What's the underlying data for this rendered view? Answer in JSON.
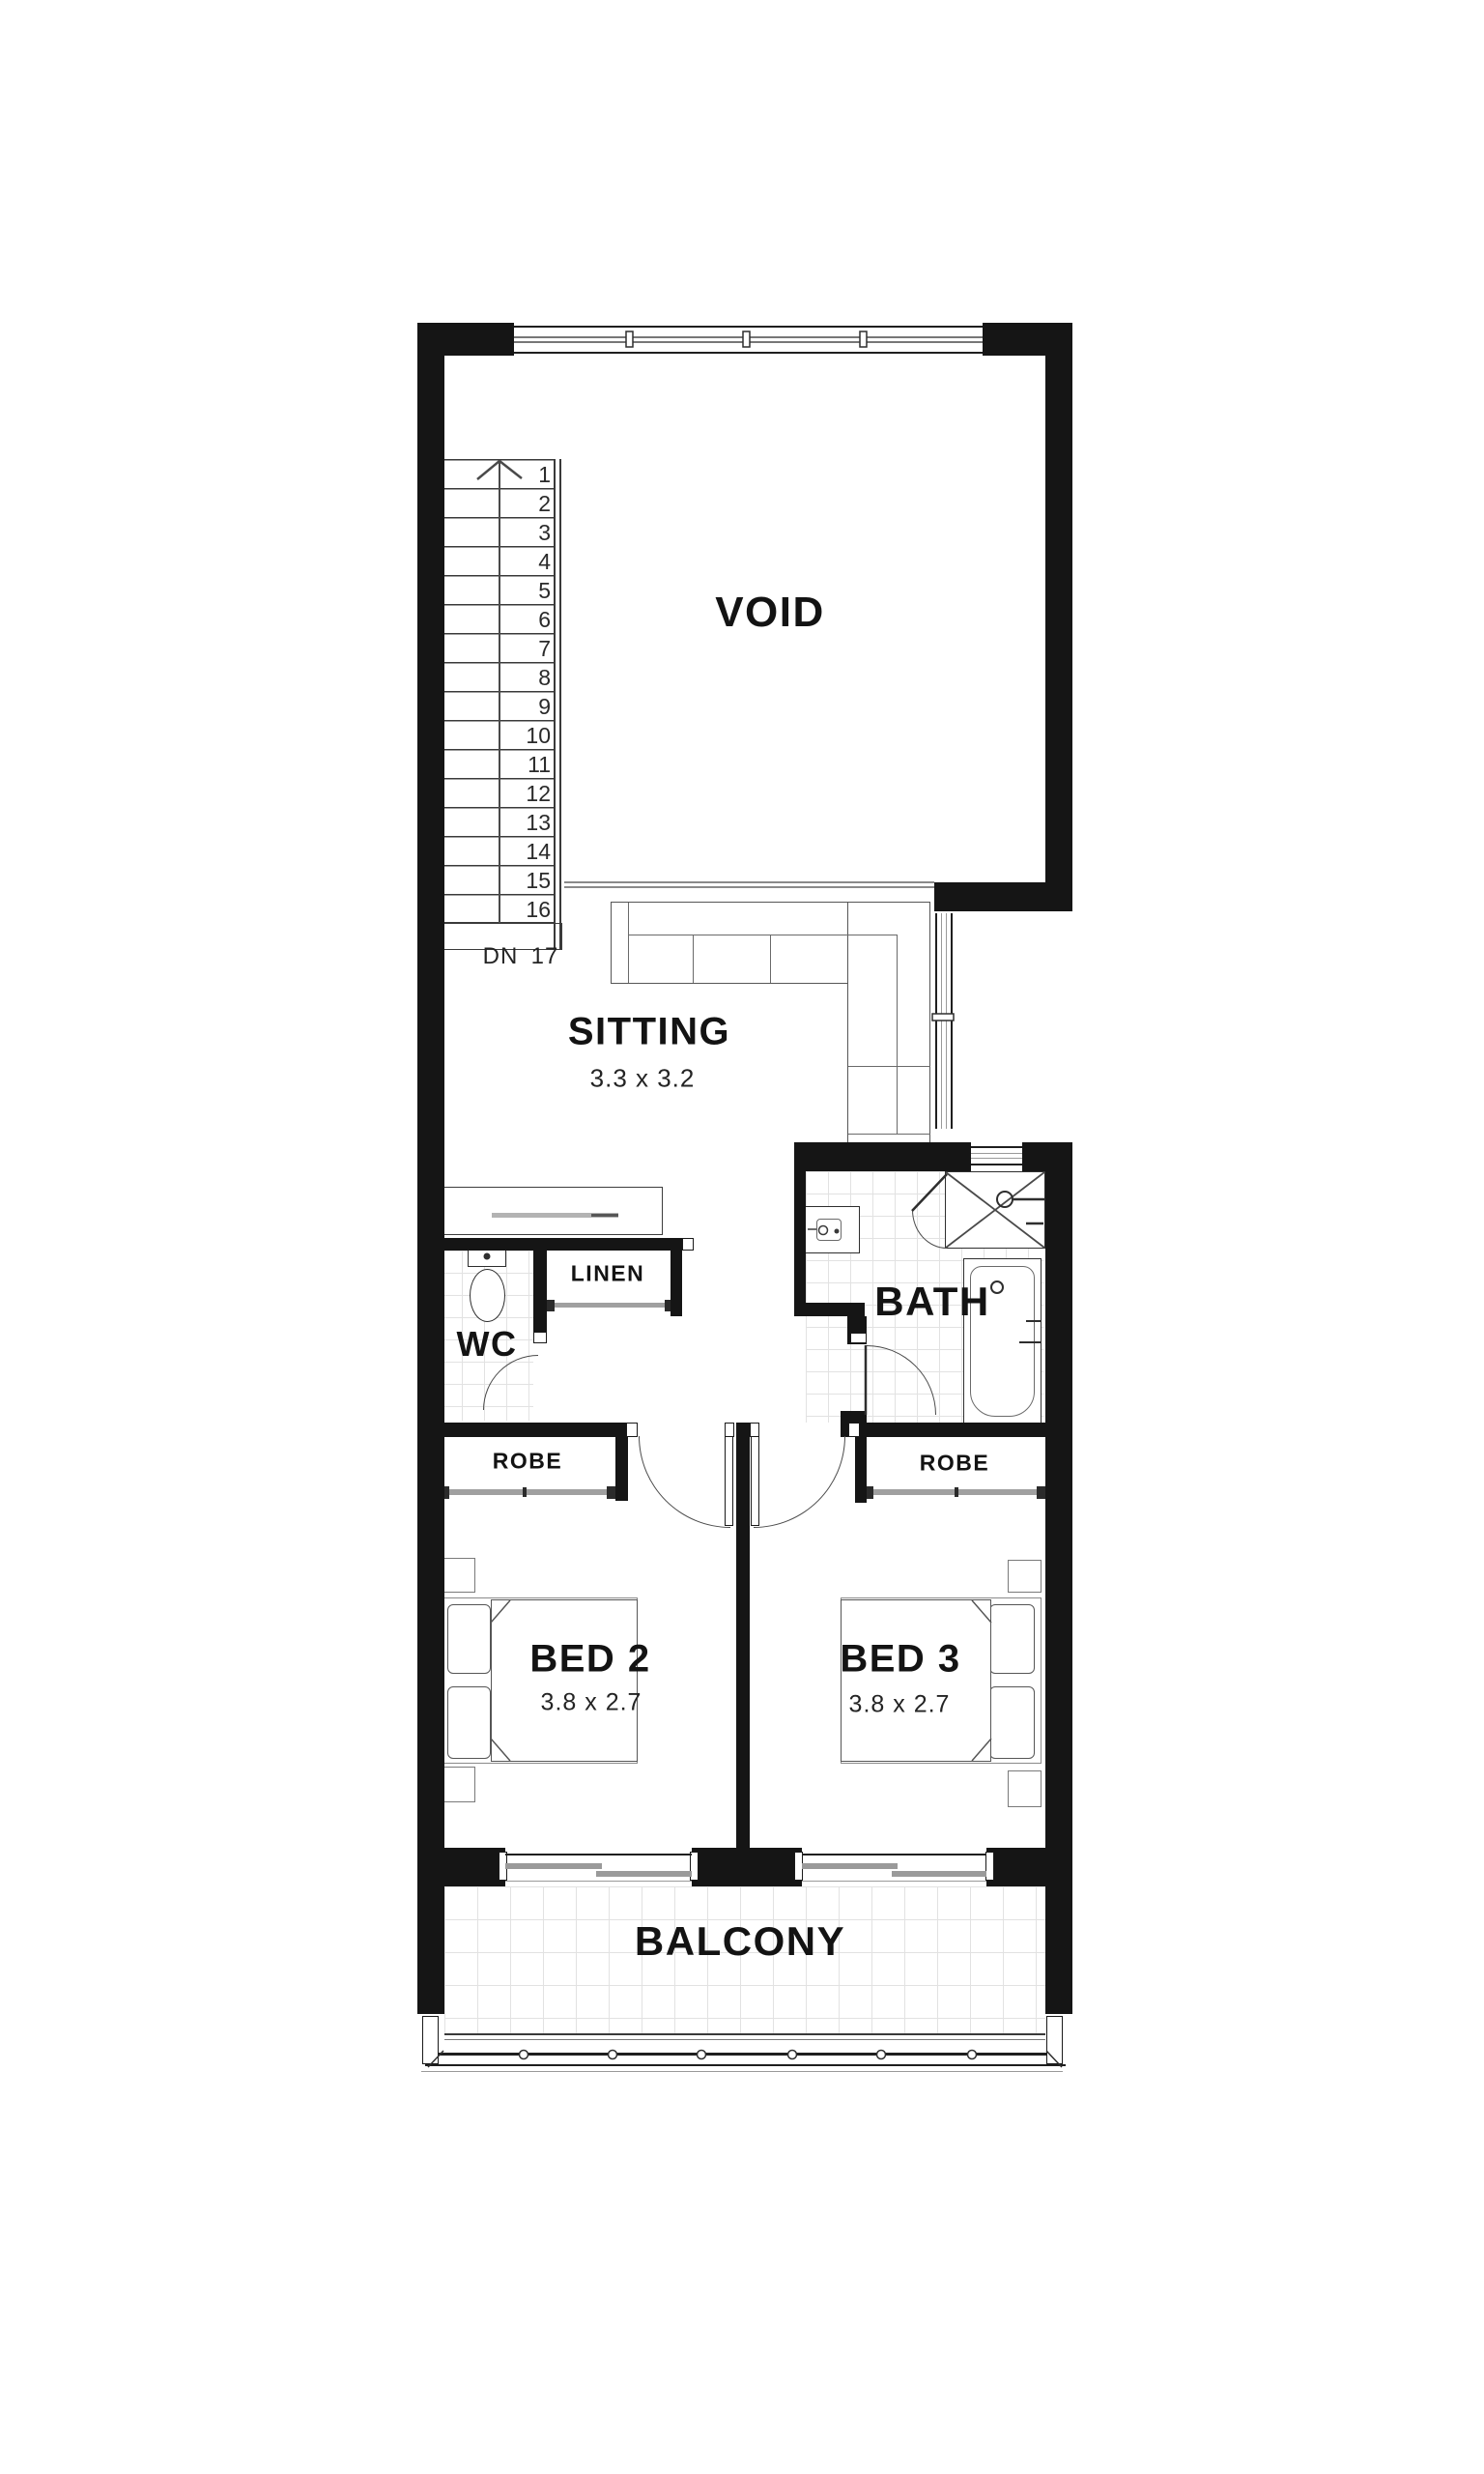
{
  "rooms": {
    "void": {
      "label": "VOID"
    },
    "sitting": {
      "label": "SITTING",
      "dims": "3.3 x 3.2"
    },
    "wc": {
      "label": "WC"
    },
    "linen": {
      "label": "LINEN"
    },
    "bath": {
      "label": "BATH"
    },
    "robe_left": {
      "label": "ROBE"
    },
    "robe_right": {
      "label": "ROBE"
    },
    "bed2": {
      "label": "BED 2",
      "dims": "3.8 x 2.7"
    },
    "bed3": {
      "label": "BED 3",
      "dims": "3.8 x 2.7"
    },
    "balcony": {
      "label": "BALCONY"
    }
  },
  "stairs": {
    "steps": [
      "1",
      "2",
      "3",
      "4",
      "5",
      "6",
      "7",
      "8",
      "9",
      "10",
      "11",
      "12",
      "13",
      "14",
      "15",
      "16"
    ],
    "last_step": "17",
    "down_label": "DN"
  },
  "colors": {
    "wall": "#151515",
    "tile_line": "#e2e2e2",
    "glass_line": "#9a9a9a",
    "fixture_line": "#565656"
  }
}
